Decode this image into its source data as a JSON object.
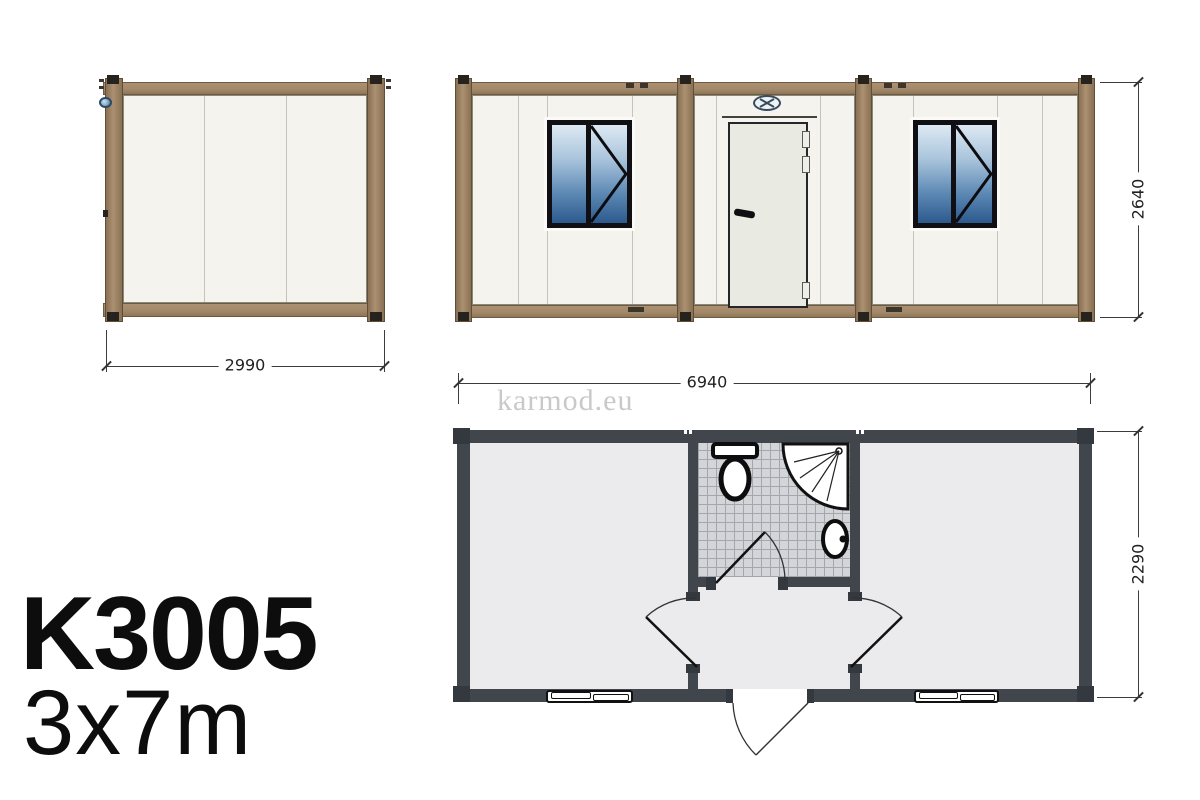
{
  "product": {
    "model": "K3005",
    "size": "3x7m"
  },
  "watermark": "karmod.eu",
  "dimensions": {
    "side_width": "2990",
    "plan_width": "6940",
    "front_height": "2640",
    "plan_depth": "2290"
  },
  "colors": {
    "frame_brown": "#a3896a",
    "frame_fitting_dark": "#26221d",
    "panel_offwhite": "#f4f3ee",
    "glass_blue_top": "#dde9f3",
    "glass_blue_bottom": "#2c5a8d",
    "door_leaf": "#e9ebe3",
    "plan_wall_dark": "#41464c",
    "plan_floor": "#ebebed",
    "bathroom_tile": "#d4d5d9",
    "dimension_text": "#222222",
    "watermark_gray": "#c9c9c9"
  },
  "views": {
    "side_elevation": {
      "panel_count": 3
    },
    "front_elevation": {
      "window_count": 2,
      "door_count": 1
    },
    "floor_plan": {
      "fixtures": [
        "toilet",
        "shower",
        "sink"
      ]
    }
  }
}
